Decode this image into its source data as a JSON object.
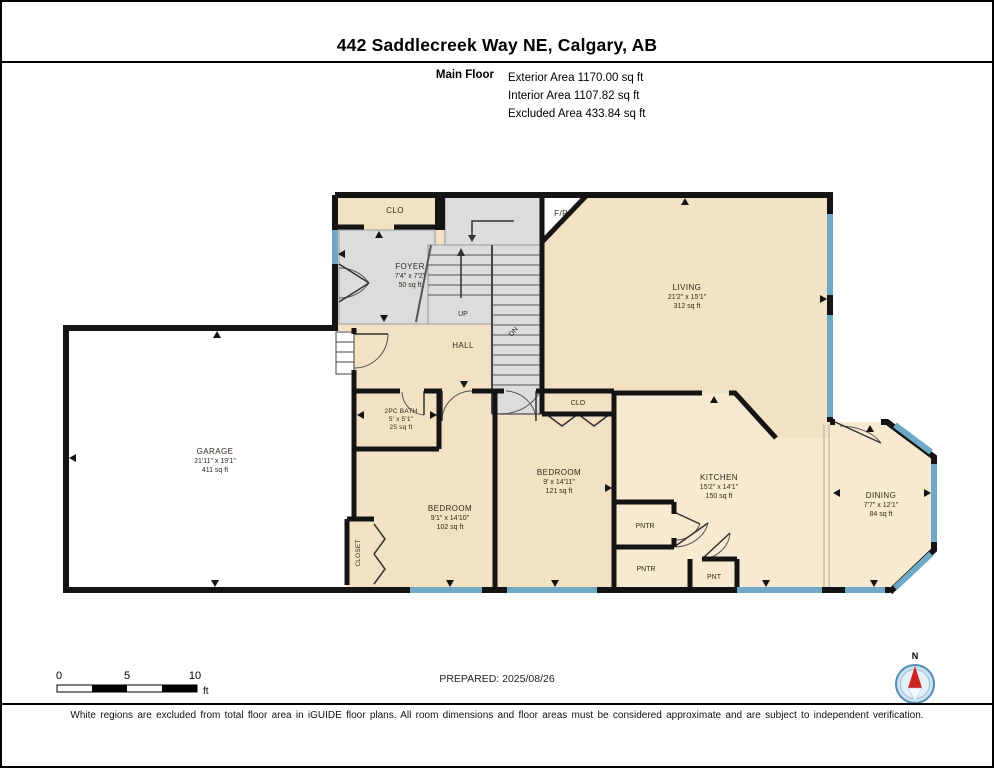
{
  "page": {
    "title": "442 Saddlecreek Way NE, Calgary, AB"
  },
  "header": {
    "floor_label": "Main Floor",
    "exterior": "Exterior Area 1170.00 sq ft",
    "interior": "Interior Area 1107.82 sq ft",
    "excluded": "Excluded Area 433.84 sq ft"
  },
  "rooms": {
    "foyer_closet": {
      "name": "CLO"
    },
    "foyer": {
      "name": "FOYER",
      "dims": "7'4\" x 7'2\"",
      "area": "50 sq ft"
    },
    "fireplace": {
      "name": "F/P"
    },
    "living": {
      "name": "LIVING",
      "dims": "21'2\" x 15'1\"",
      "area": "312 sq ft"
    },
    "stairs": {
      "up": "UP",
      "down": "DN"
    },
    "hall": {
      "name": "HALL"
    },
    "garage": {
      "name": "GARAGE",
      "dims": "21'11\" x 19'1\"",
      "area": "411 sq ft"
    },
    "bath": {
      "name": "2PC BATH",
      "dims": "5' x 5'1\"",
      "area": "25 sq ft"
    },
    "bedroom_left": {
      "name": "BEDROOM",
      "dims": "9'1\" x 14'10\"",
      "area": "102 sq ft"
    },
    "closet": {
      "name": "CLOSET"
    },
    "bedroom_right": {
      "name": "BEDROOM",
      "dims": "9' x 14'11\"",
      "area": "121 sq ft"
    },
    "bedroom_right_closet": {
      "name": "CLO"
    },
    "kitchen": {
      "name": "KITCHEN",
      "dims": "15'2\" x 14'1\"",
      "area": "150 sq ft"
    },
    "pantry_upper": {
      "name": "PNTR"
    },
    "pantry_lower": {
      "name": "PNTR"
    },
    "pantry_small": {
      "name": "PNT"
    },
    "dining": {
      "name": "DINING",
      "dims": "7'7\" x 12'1\"",
      "area": "84 sq ft"
    }
  },
  "footer": {
    "scale": {
      "ticks": [
        "0",
        "5",
        "10"
      ],
      "unit": "ft"
    },
    "prepared": "PREPARED: 2025/08/26",
    "compass": "N",
    "disclaimer": "White regions are excluded from total floor area in iGUIDE floor plans. All room dimensions and floor areas must be considered approximate and are subject to independent verification."
  },
  "colors": {
    "room_fill": "#f3e1c3",
    "kitchen_fill": "#f8ead0",
    "stair_fill": "#dcdcdc",
    "garage_fill": "#ffffff",
    "wall": "#141414",
    "window": "#6fa9c6",
    "compass_ring": "#4d8fb5",
    "compass_needle": "#cc2222"
  }
}
